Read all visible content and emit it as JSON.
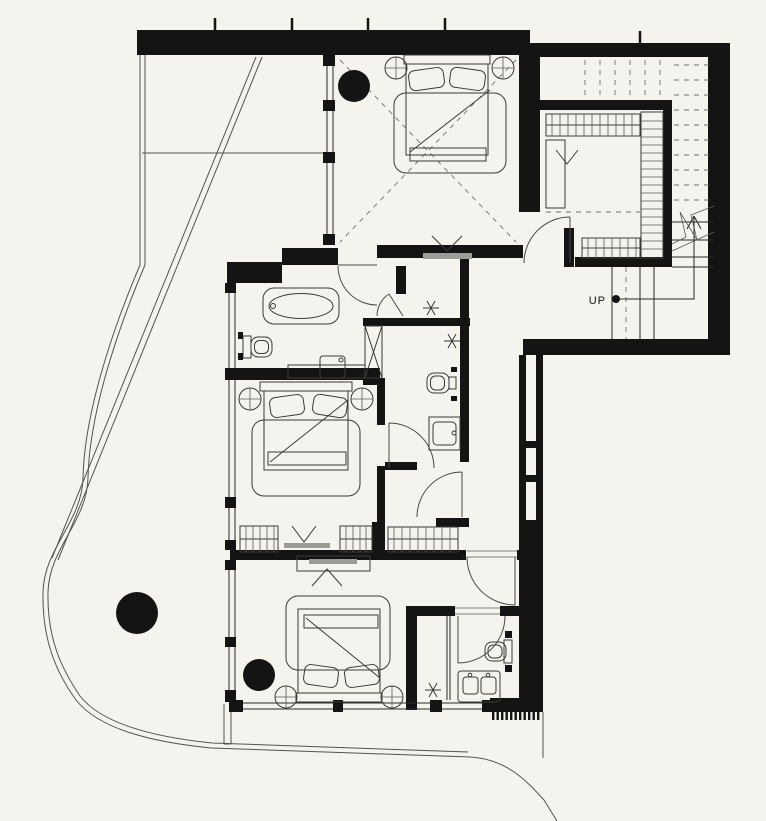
{
  "plan": {
    "up_label": "UP",
    "colors": {
      "background": "#f5f3ee",
      "walls": "#141414",
      "lines": "#2a2a2a",
      "muted": "#6f6f6a",
      "tv_fill": "#9c9c96"
    },
    "fixtures": [
      "double-bed-top",
      "double-bed-middle",
      "double-bed-bottom",
      "freestanding-bathtub",
      "wall-hung-toilet-ensuite",
      "wall-hung-toilet-wc",
      "wall-hung-toilet-guest",
      "vanity-basin-ensuite",
      "vanity-basin-wc",
      "double-vanity-guest",
      "shower-stall",
      "walk-in-closet",
      "staircase-up",
      "structural-columns",
      "site-boundary"
    ]
  }
}
